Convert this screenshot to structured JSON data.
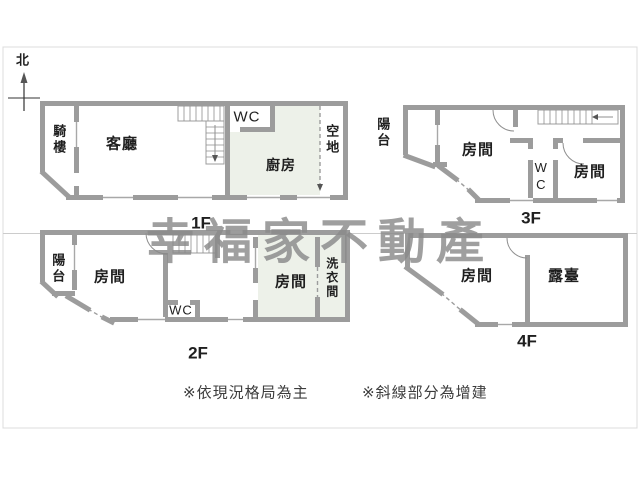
{
  "north": "北",
  "watermark": "幸福家不動產",
  "f1": {
    "label": "1F",
    "arcade": "騎樓",
    "living": "客廳",
    "wc": "WC",
    "kitchen": "廚房",
    "open_space": "空地"
  },
  "f2": {
    "label": "2F",
    "balcony": "陽台",
    "room1": "房間",
    "wc": "WC",
    "room2": "房間",
    "laundry": "洗衣間"
  },
  "f3": {
    "label": "3F",
    "balcony": "陽台",
    "room1": "房間",
    "wc": "WC",
    "room2": "房間"
  },
  "f4": {
    "label": "4F",
    "room": "房間",
    "terrace": "露臺"
  },
  "notes": {
    "note1": "※依現況格局為主",
    "note2": "※斜線部分為增建"
  },
  "colors": {
    "wall": "#9c9c9c",
    "addition_fill": "#edf1e9",
    "watermark": "#8a8a8a",
    "frame_border": "#dcdcdc"
  }
}
